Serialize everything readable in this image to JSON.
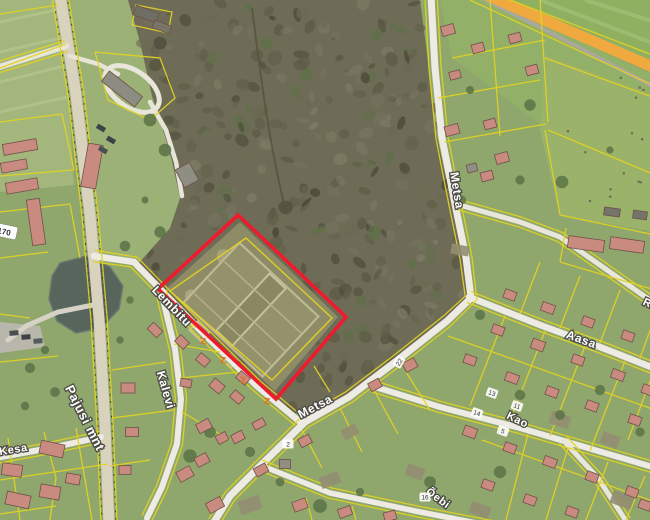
{
  "map": {
    "streets": [
      {
        "id": "pajusi-mnt",
        "text": "Pajusi mnt"
      },
      {
        "id": "lembitu",
        "text": "Lembitu"
      },
      {
        "id": "kalevi",
        "text": "Kalevi"
      },
      {
        "id": "metsa-south",
        "text": "Metsa"
      },
      {
        "id": "metsa-north",
        "text": "Metsa"
      },
      {
        "id": "aasa",
        "text": "Aasa"
      },
      {
        "id": "kao",
        "text": "Kao"
      },
      {
        "id": "kesa",
        "text": "Kesa"
      },
      {
        "id": "oebi",
        "text": "Õebi"
      },
      {
        "id": "r-partial",
        "text": "R"
      }
    ],
    "road_number": "4170",
    "house_numbers": [
      "22",
      "13",
      "11",
      "14",
      "5",
      "16",
      "2"
    ],
    "colors": {
      "parcel_highlight": "#ee1b2d",
      "cadastral_line": "#e3d321",
      "highway_fill": "#f0a93f",
      "water": "#57655c",
      "forest_base": "#6e6c56"
    }
  }
}
